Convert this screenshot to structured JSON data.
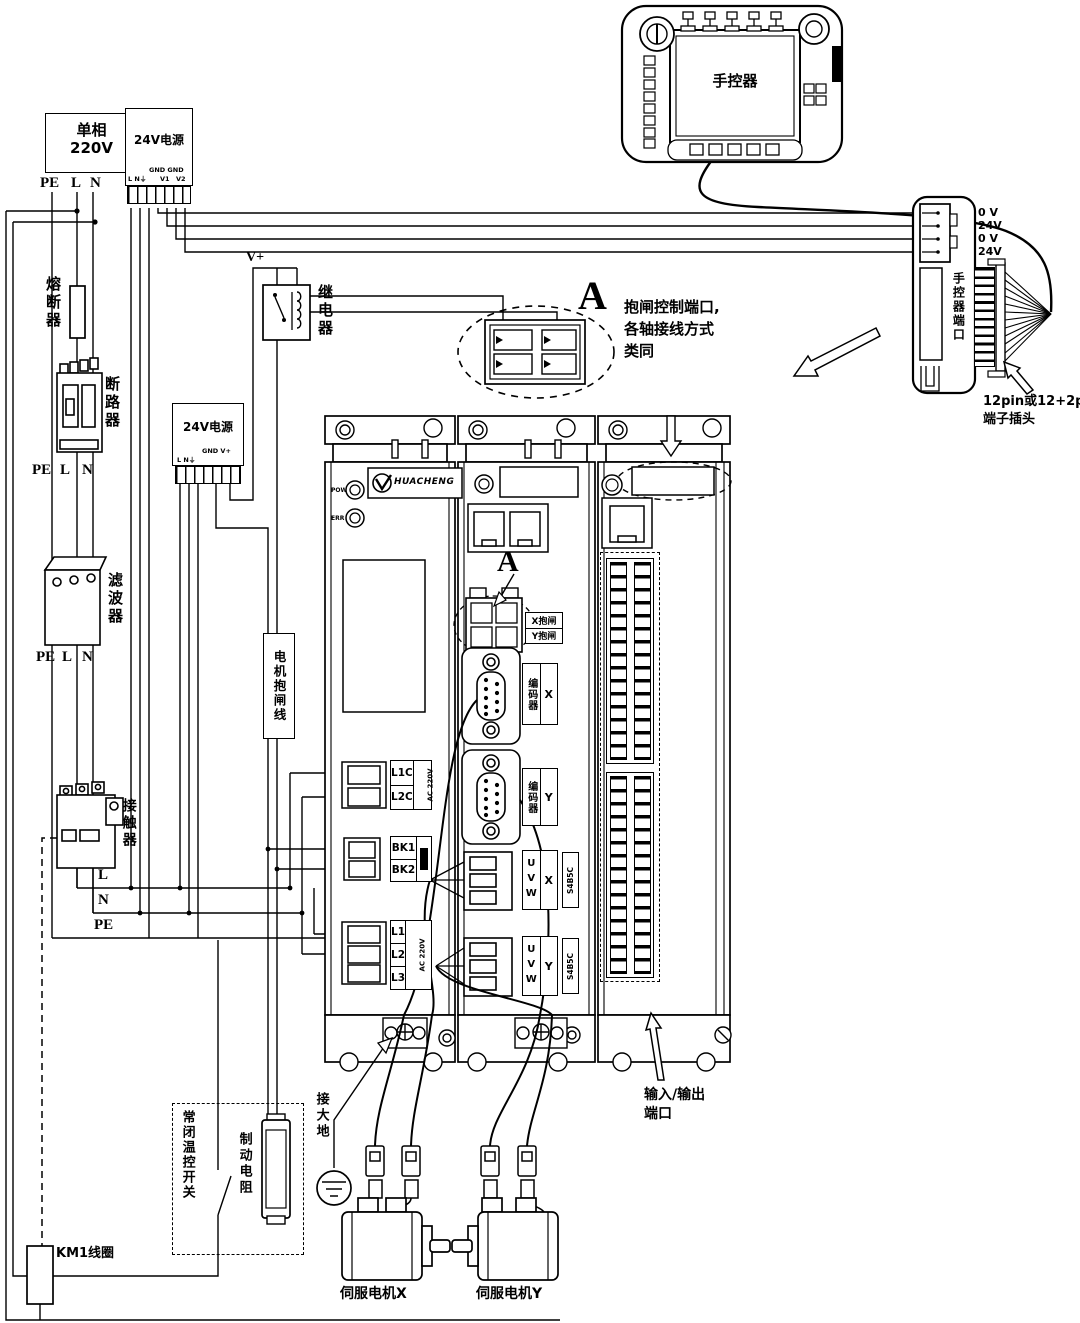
{
  "mains": {
    "l1": "单相",
    "l2": "220V",
    "pe": "PE",
    "l": "L",
    "n": "N"
  },
  "psu1": {
    "title": "24V电源",
    "gnd": "GND GND",
    "lne": "L N⏚",
    "v1": "V1",
    "v2": "V2"
  },
  "psu2": {
    "title": "24V电源",
    "gnd": "GND V+",
    "lne": "L N⏚"
  },
  "fuse": {
    "label": "熔断器"
  },
  "breaker": {
    "label": "断路器",
    "pe": "PE",
    "l": "L",
    "n": "N"
  },
  "filter": {
    "label": "滤波器",
    "pe": "PE",
    "l": "L",
    "n": "N"
  },
  "contactor": {
    "label": "接触器",
    "l": "L",
    "n": "N",
    "pe": "PE"
  },
  "relay": {
    "label": "继电器",
    "vplus": "V+"
  },
  "brakeline": {
    "label": "电机抱闸线"
  },
  "detail_a": {
    "letter": "A",
    "note1": "抱闸控制端口,",
    "note2": "各轴接线方式",
    "note3": "类同"
  },
  "pendant": {
    "label": "手控器"
  },
  "port": {
    "pin1": "0 V",
    "pin2": "24V",
    "pin3": "0 V",
    "pin4": "24V",
    "title": "手控器端口",
    "note1": "12pin或12+2pin",
    "note2": "端子插头"
  },
  "drive": {
    "brand": "HUACHENG",
    "pow": "POW",
    "err": "ERR",
    "a_letter": "A",
    "xbrake": "X抱闸",
    "ybrake": "Y抱闸",
    "encoder": "编码器",
    "x": "X",
    "y": "Y",
    "uvw": "UVW",
    "s45": "S4B5C",
    "l1c": "L1C",
    "l2c": "L2C",
    "ac220": "AC 220V",
    "bk1": "BK1",
    "bk2": "BK2",
    "l1": "L1",
    "l2": "L2",
    "l3": "L3",
    "io1": "输入/输出",
    "io2": "端口"
  },
  "ground": {
    "label": "接大地"
  },
  "thermal": {
    "label": "常闭温控开关"
  },
  "resistor": {
    "label": "制动电阻"
  },
  "km1": {
    "label": "KM1线圈"
  },
  "motor_x": {
    "label": "伺服电机X"
  },
  "motor_y": {
    "label": "伺服电机Y"
  }
}
